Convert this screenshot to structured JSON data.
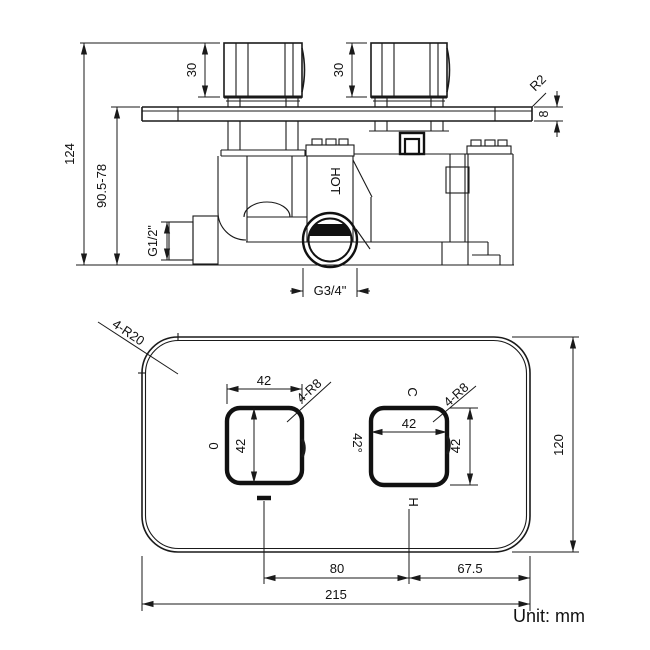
{
  "unit_label": "Unit: mm",
  "top_view": {
    "dims": {
      "total_height": "124",
      "install_depth": "90.5-78",
      "knob1_height": "30",
      "knob2_height": "30",
      "plate_corner_radius": "R2",
      "plate_thickness": "8",
      "inlet_thread": "G1/2\"",
      "outlet_thread": "G3/4\"",
      "hot_label": "HOT"
    }
  },
  "bottom_view": {
    "dims": {
      "plate_corner_radius": "4-R20",
      "plate_width": "215",
      "plate_height": "120",
      "knob_spacing": "80",
      "right_offset": "67.5",
      "left_knob_width": "42",
      "left_knob_height": "42",
      "left_knob_corner": "4-R8",
      "left_knob_label": "0",
      "right_knob_width": "42",
      "right_knob_height": "42",
      "right_knob_corner": "4-R8",
      "right_knob_angle": "42°",
      "cold_label": "C",
      "hot_label": "H"
    }
  }
}
